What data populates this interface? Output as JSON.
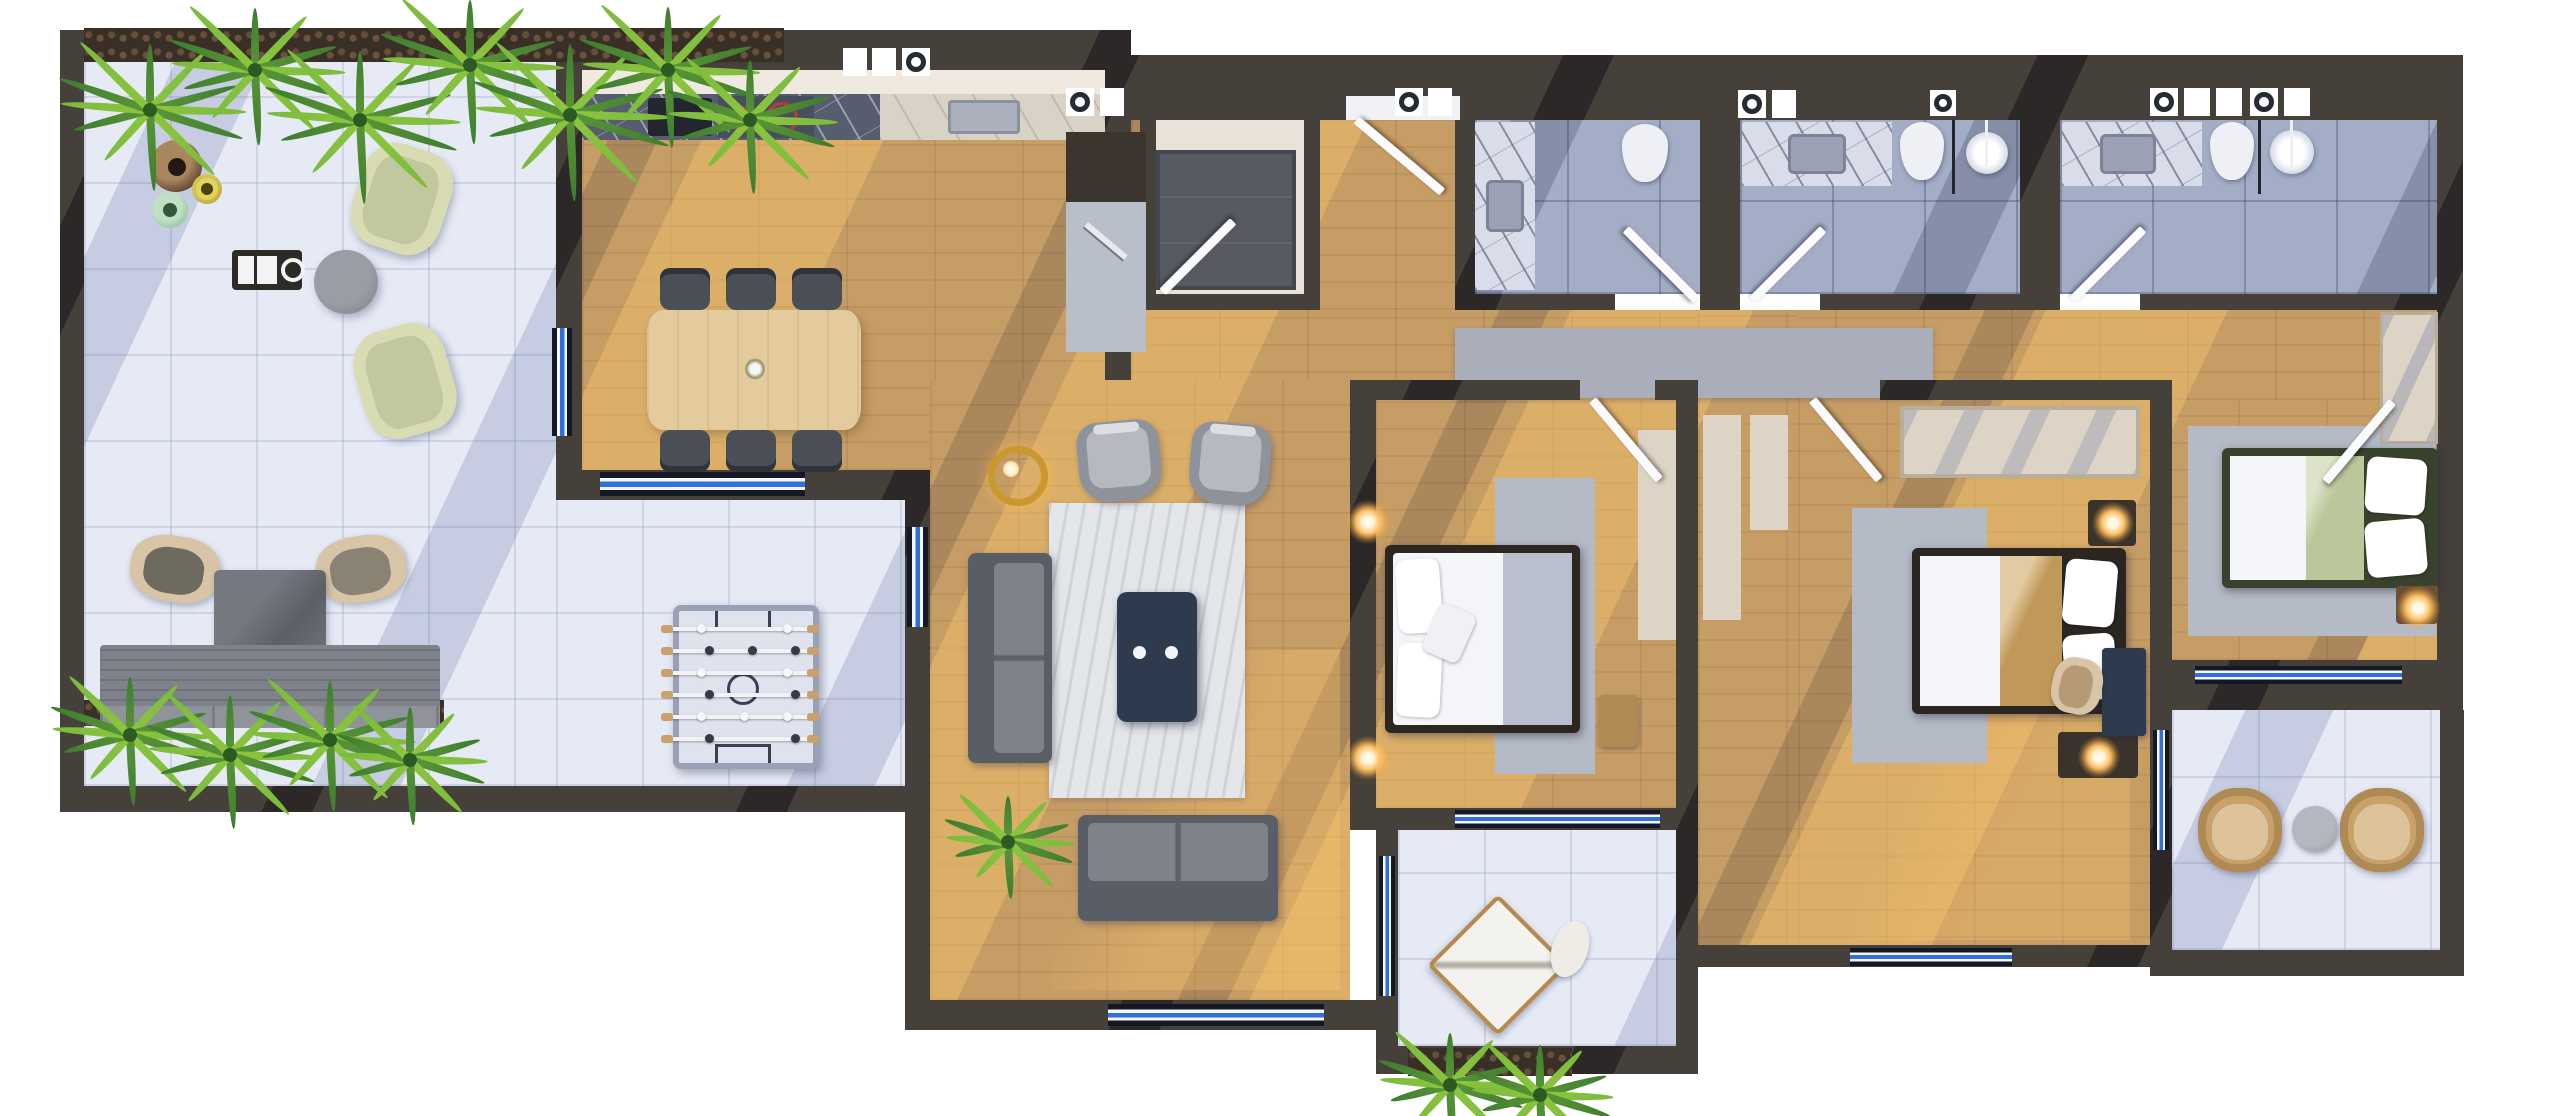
{
  "meta": {
    "view": "top-down 3d floor plan render",
    "text_visible": false
  },
  "palette": {
    "wall": "#46403a",
    "wall_shadow": "#2b2622",
    "wood": "#c79d66",
    "wood_sun": "#ecc27e",
    "tile": "#e6eaf5",
    "bath_tile": "#a4adc6",
    "marble_light": "#d9dde9",
    "marble_dark": "#5b6172",
    "counter_light": "#d9d2c6",
    "counter_dark": "#565d6e",
    "window_blue": "#2f6fe0",
    "window_dark": "#141824",
    "rug_light": "#e4e6ea",
    "rug_gray": "#b4bac6",
    "runner_gray": "#a9aeba",
    "sofa_gray": "#595e66",
    "sofa_cushion": "#7e828a",
    "armchair_gray": "#8e939b",
    "coffee_table_navy": "#2e3a4d",
    "dining_wood": "#e3cb9d",
    "chair_dark": "#4a4e55",
    "green_chair": "#d9dcb2",
    "green_cushion": "#c2c89e",
    "tan": "#d8c4a6",
    "wicker": "#c9a26b",
    "bed_frame": "#2b2620",
    "bed_frame_green": "#39422c",
    "blanket_tan": "#c09857",
    "blanket_green": "#b9c79b",
    "blanket_gray": "#b9bfcc",
    "sheet_white": "#f3f5f9",
    "toilet_white": "#eef0f6",
    "beige_wall": "#ded4c5",
    "closet_beige": "#e8e2d8",
    "wardrobe_gray": "#555a63",
    "gold": "#c9982f",
    "lamp_glow": "#ffc063",
    "fern_dark": "#3e7d2f",
    "fern_light": "#7cba3d",
    "soil": "#3a2f26",
    "hob_ring_red": "#c03a2e"
  },
  "rooms": [
    {
      "name": "terrace",
      "floor": "white-tile",
      "features": [
        "fern-planter-top",
        "fern-planter-bottom",
        "decor-vases-brown-yellow-green",
        "grill-cart",
        "lounge-armchair-green-x2",
        "round-coffee-table",
        "armchair-tan-x2",
        "outdoor-table-gray",
        "garden-bench-gray",
        "foosball-table"
      ]
    },
    {
      "name": "kitchen-dining",
      "floor": "wood",
      "features": [
        "kitchen-counter-marble",
        "cooktop-2-rings",
        "counter-sink",
        "side-counter-cutting-board",
        "dining-table-wood",
        "dining-chair-x6",
        "window-left",
        "window-bottom"
      ]
    },
    {
      "name": "entry-hall",
      "floor": "wood",
      "features": [
        "entrance-door",
        "runner-rug"
      ]
    },
    {
      "name": "closet-room",
      "floor": "beige",
      "features": [
        "wardrobe-dark",
        "door"
      ]
    },
    {
      "name": "bathroom-1",
      "floor": "gray-tile",
      "features": [
        "marble-vanity",
        "sink",
        "toilet",
        "door"
      ]
    },
    {
      "name": "bathroom-2",
      "floor": "gray-tile",
      "features": [
        "marble-vanity",
        "sink",
        "toilet",
        "shower",
        "glass-divider",
        "door"
      ]
    },
    {
      "name": "bathroom-3",
      "floor": "gray-tile",
      "features": [
        "marble-vanity",
        "sink",
        "toilet",
        "shower",
        "glass-divider",
        "door"
      ]
    },
    {
      "name": "living-room",
      "floor": "wood",
      "features": [
        "armchair-gray-x2",
        "pendant-lamp-gold",
        "area-rug-light",
        "coffee-table-navy",
        "sofa-left",
        "sofa-bottom",
        "potted-fern",
        "window-bottom"
      ]
    },
    {
      "name": "bedroom-1",
      "floor": "wood",
      "features": [
        "double-bed-gray-white",
        "wall-lamp-x2",
        "area-rug",
        "wardrobe-panel",
        "bench-stool",
        "door",
        "window-bottom"
      ]
    },
    {
      "name": "balcony-1",
      "floor": "white-tile",
      "features": [
        "chaise-lounge-diamond",
        "seat-cushion",
        "fern-planter"
      ]
    },
    {
      "name": "bedroom-2",
      "floor": "wood",
      "features": [
        "double-bed-tan-white",
        "wardrobe-beige",
        "nightstand-lamp-x2",
        "desk-navy",
        "chair-tan",
        "area-rug",
        "door",
        "window-bottom"
      ]
    },
    {
      "name": "bedroom-3",
      "floor": "wood",
      "features": [
        "double-bed-green-white",
        "wardrobe-mirror",
        "nightstand-lamp",
        "area-rug",
        "door",
        "window-bottom"
      ]
    },
    {
      "name": "balcony-2",
      "floor": "white-tile",
      "features": [
        "wicker-chair-x2",
        "round-side-table"
      ]
    }
  ]
}
